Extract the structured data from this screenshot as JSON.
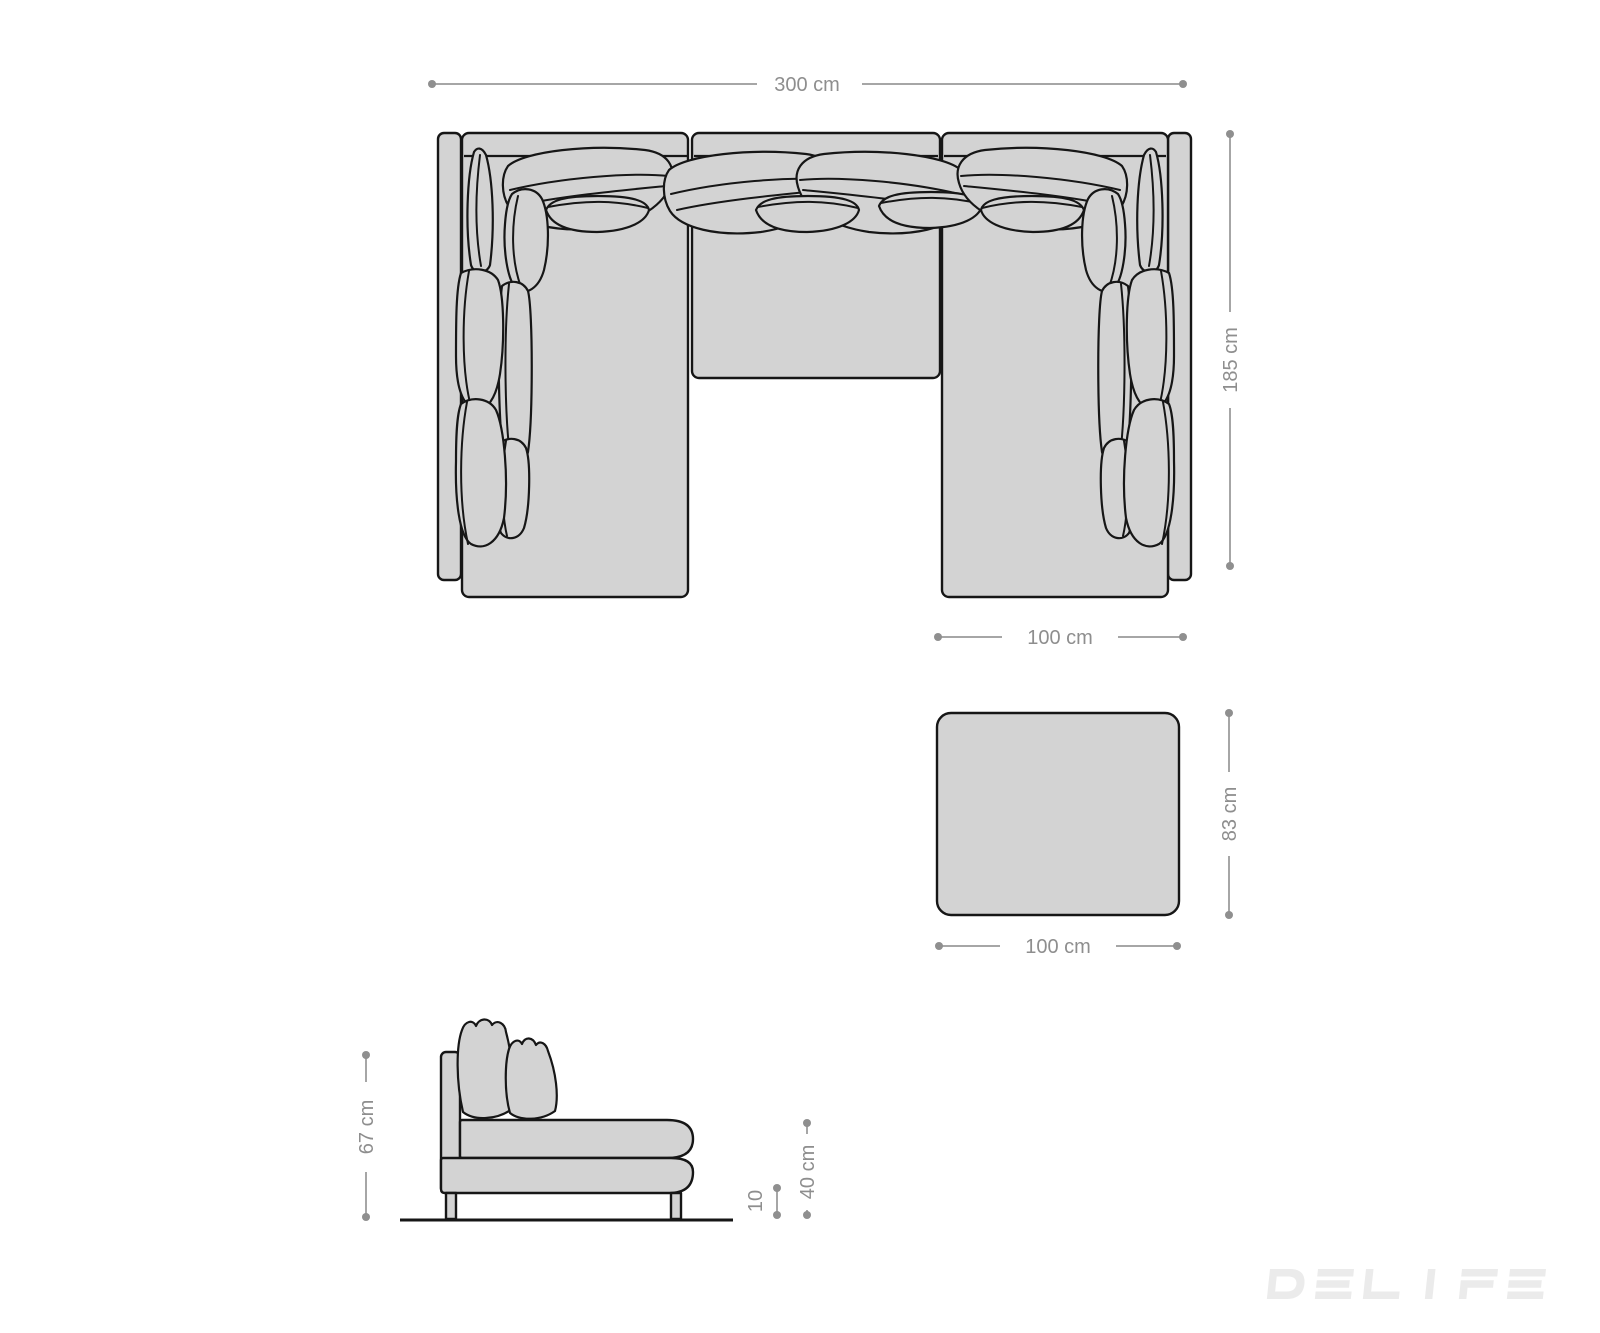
{
  "colors": {
    "background": "#ffffff",
    "furniture-fill": "#d3d3d3",
    "outline": "#161616",
    "dim-line": "#a6a6a6",
    "dim-dot": "#8f8f8f",
    "dim-text": "#8e8e8e",
    "watermark": "#ebebeb"
  },
  "plan_view": {
    "width_label": "300 cm",
    "depth_label": "185 cm",
    "section_width_label": "100 cm"
  },
  "stool": {
    "width_label": "100 cm",
    "depth_label": "83 cm"
  },
  "side_view": {
    "height_label": "67 cm",
    "seat_height_label": "40 cm",
    "leg_height_label": "10"
  },
  "watermark": {
    "text": "DELIFE"
  }
}
